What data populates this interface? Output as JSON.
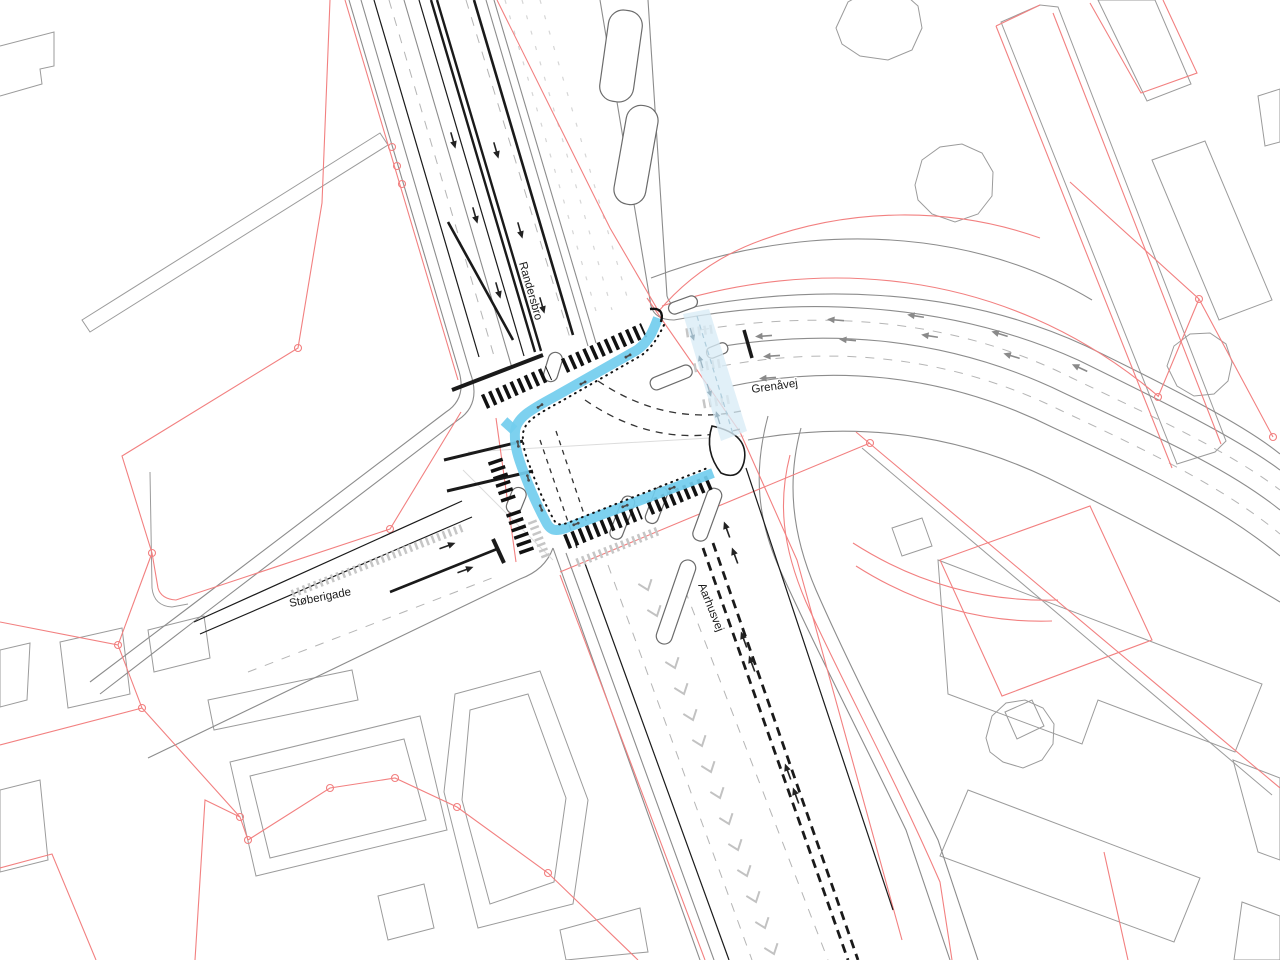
{
  "plan": {
    "title": "Intersection site plan",
    "streets": {
      "north": {
        "label": "Randersbro"
      },
      "east": {
        "label": "Grenåvej"
      },
      "south": {
        "label": "Aarhusvej"
      },
      "west": {
        "label": "Støberigade"
      }
    }
  },
  "colors": {
    "background": "#ffffff",
    "cycle_route": "#72cdee",
    "crossing_band": "#d9ecf6",
    "parcel_line": "#f28080",
    "building_line": "#9b9b9b",
    "road_line": "#8c8c8c",
    "marking_black": "#1a1a1a"
  }
}
